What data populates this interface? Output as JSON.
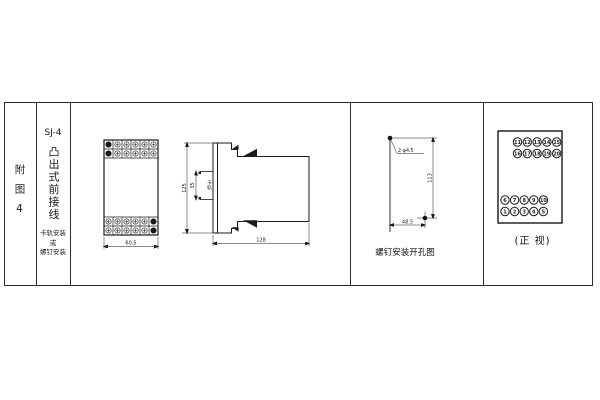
{
  "colors": {
    "line": "#1a1a1a",
    "background": "#ffffff"
  },
  "title_block": {
    "figure_label": "附图4",
    "model": "SJ-4",
    "mount_title": "凸出式前接线",
    "mount_lines": [
      "卡轨安装",
      "或",
      "螺钉安装"
    ]
  },
  "front_view": {
    "width_dim": "60.5"
  },
  "side_view": {
    "height_dim": "125",
    "rail_dim": "35",
    "rail_label": "卡轨",
    "depth_dim": "128"
  },
  "drill_view": {
    "hole_label": "2-φ4.5",
    "vertical_dim": "113",
    "horizontal_dim": "48.5",
    "caption": "螺钉安装开孔图"
  },
  "terminal_view": {
    "caption": "(正 视)",
    "rows": [
      [
        "11",
        "12",
        "13",
        "14",
        "15"
      ],
      [
        "16",
        "17",
        "18",
        "19",
        "20"
      ],
      [
        "6",
        "7",
        "8",
        "9",
        "10"
      ],
      [
        "1",
        "2",
        "3",
        "4",
        "5"
      ]
    ]
  }
}
